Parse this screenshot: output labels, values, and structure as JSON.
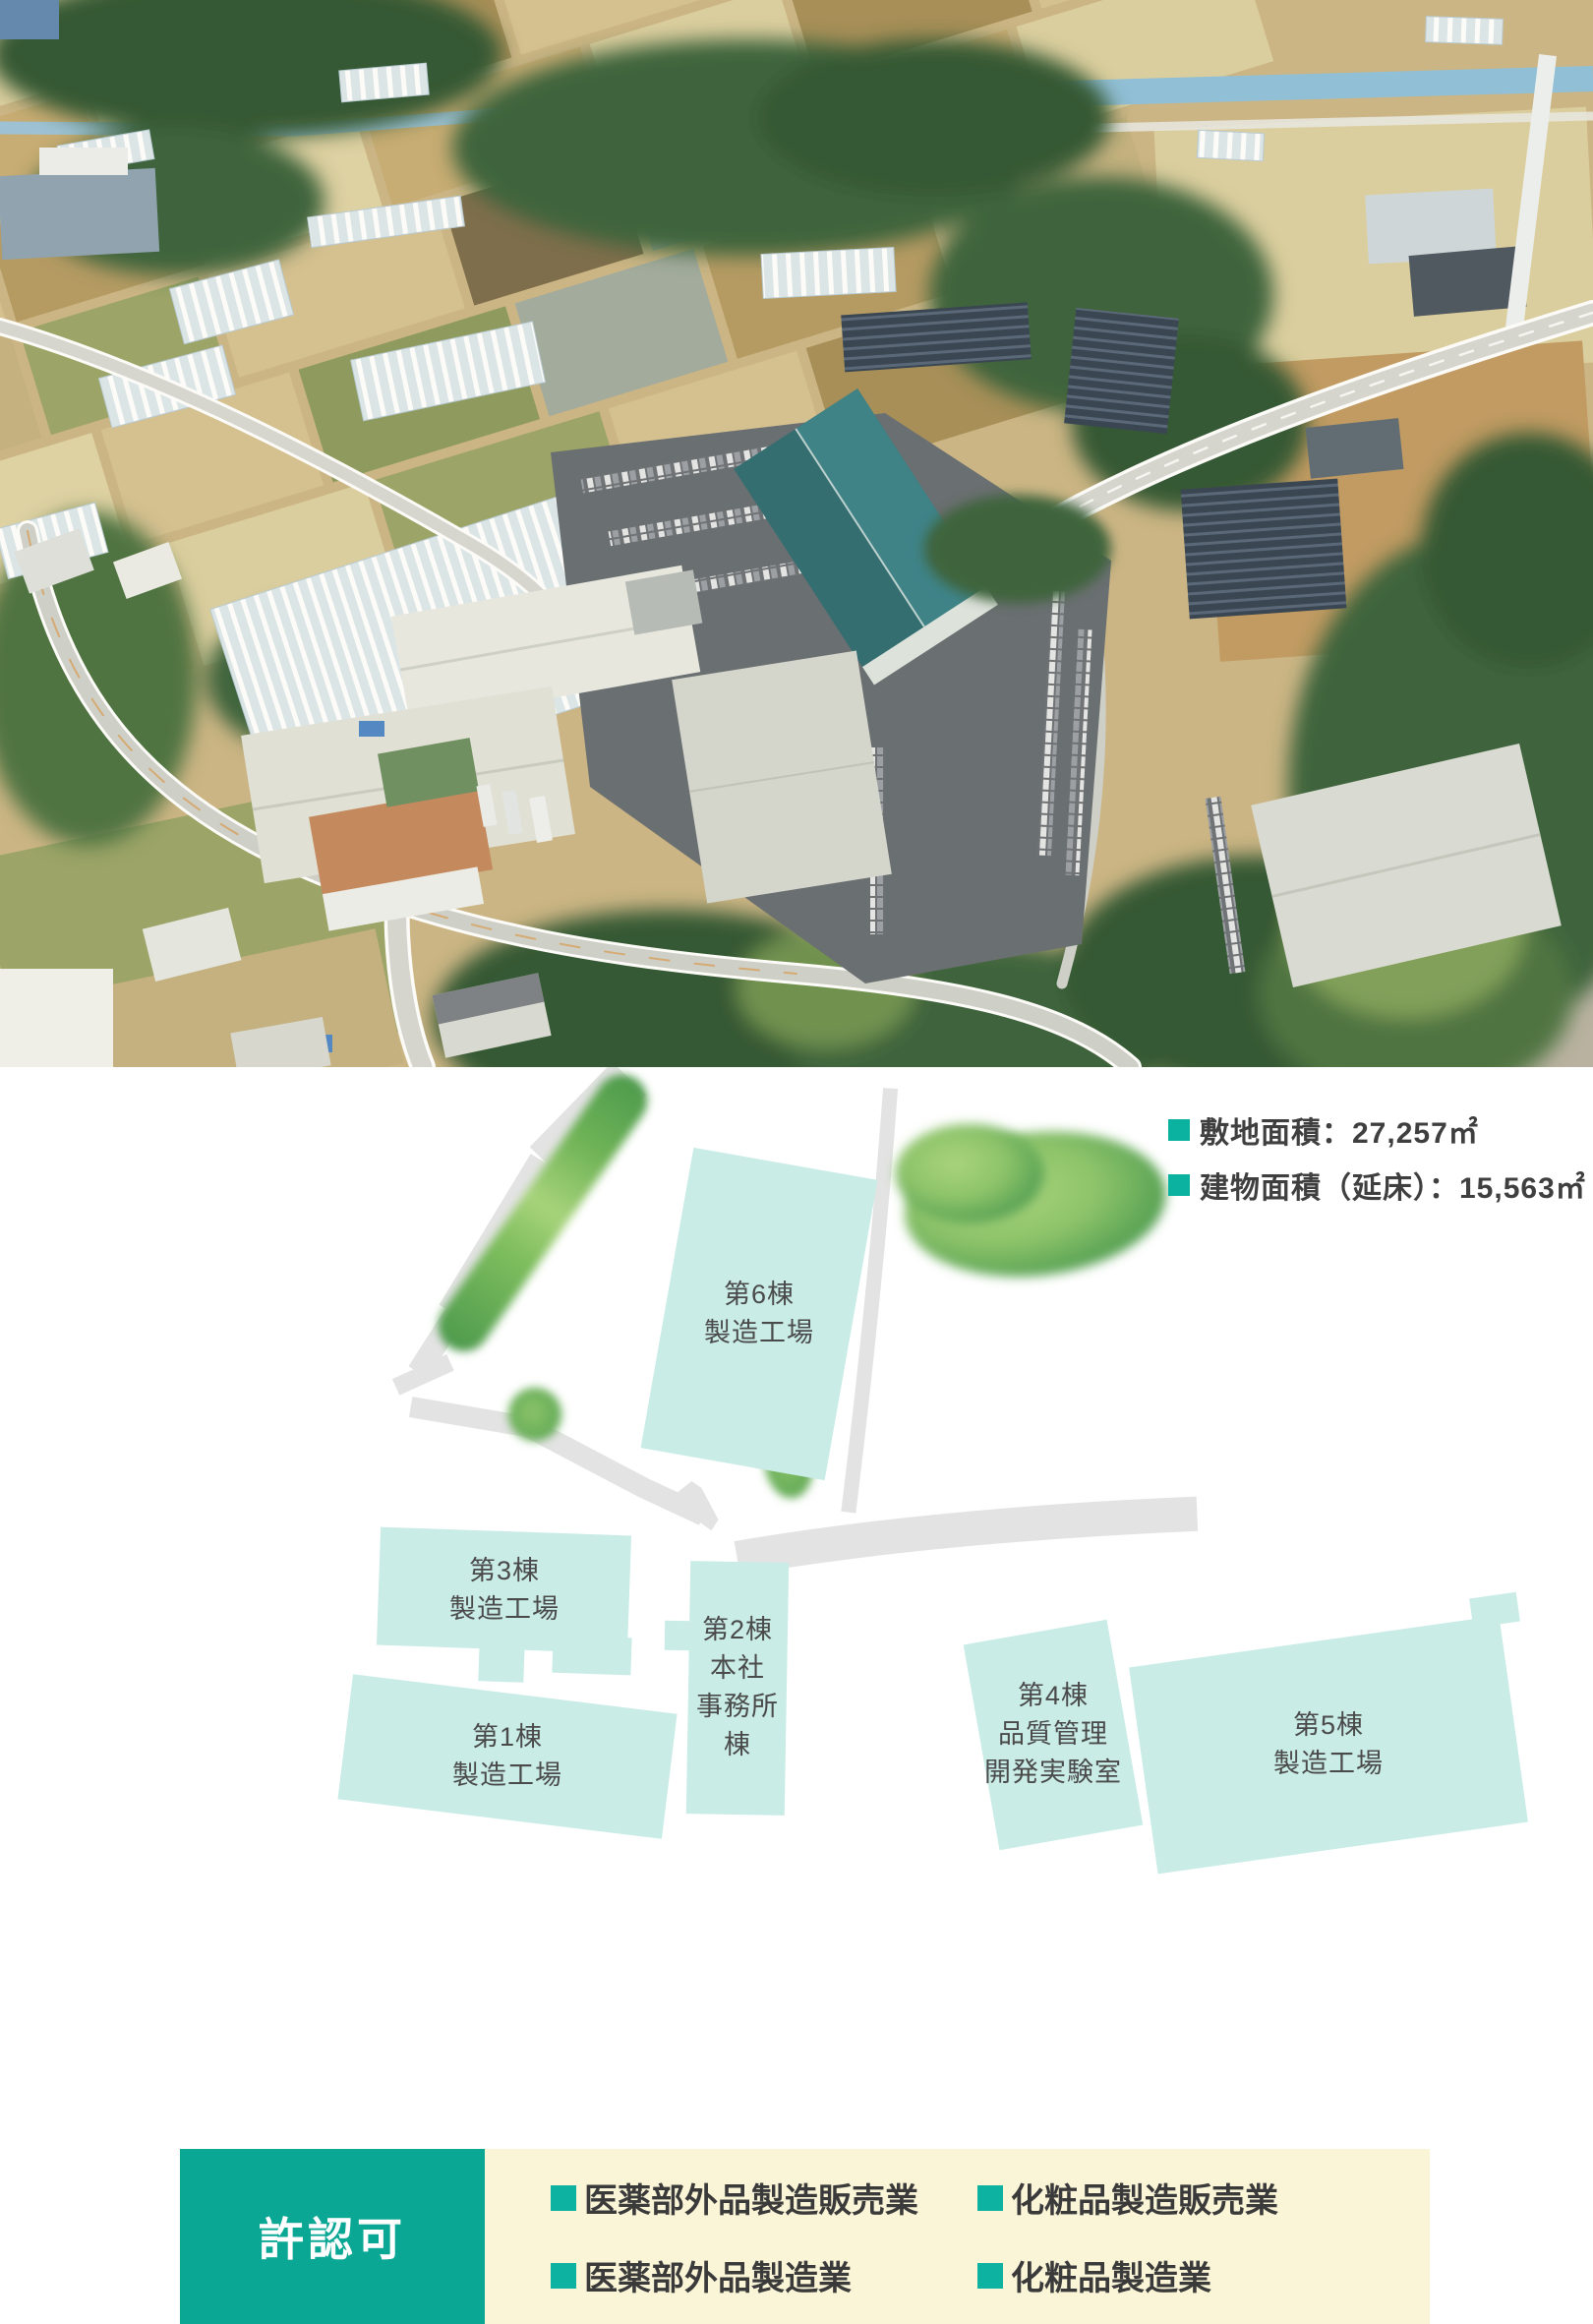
{
  "site_map": {
    "legend": [
      {
        "label": "敷地面積：27,257㎡"
      },
      {
        "label": "建物面積（延床）：15,563㎡"
      }
    ],
    "buildings": [
      {
        "id": "building-6",
        "label": "第6棟\n製造工場"
      },
      {
        "id": "building-3",
        "label": "第3棟\n製造工場"
      },
      {
        "id": "building-1",
        "label": "第1棟\n製造工場"
      },
      {
        "id": "building-2",
        "label": "第2棟\n本社\n事務所棟"
      },
      {
        "id": "building-4",
        "label": "第4棟\n品質管理\n開発実験室"
      },
      {
        "id": "building-5",
        "label": "第5棟\n製造工場"
      }
    ]
  },
  "license": {
    "title": "許認可",
    "items": [
      "医薬部外品製造販売業",
      "化粧品製造販売業",
      "医薬部外品製造業",
      "化粧品製造業"
    ]
  },
  "colors": {
    "accent_teal": "#0cb2a0",
    "license_box_teal": "#0aa794",
    "license_panel_cream": "#fbf5d8",
    "map_building_fill": "#c9ece6",
    "map_road_gray": "#e3e3e3"
  }
}
